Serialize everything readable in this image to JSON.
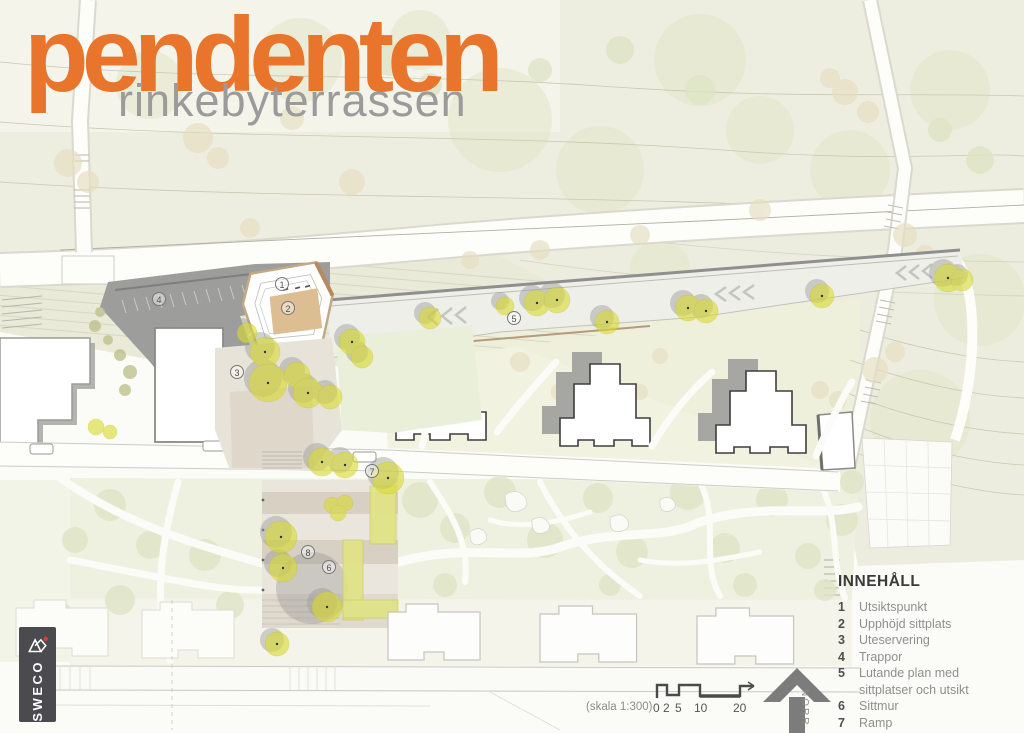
{
  "header": {
    "title": "pendenten",
    "subtitle": "rinkebyterrassen"
  },
  "colors": {
    "accent_orange": "#E8752B",
    "subtitle_gray": "#9B9B9B",
    "tree_yellow": "#D9DB33",
    "structure_gray": "#9D9D9B",
    "north_arrow_gray": "#7C7C7C"
  },
  "legend": {
    "heading": "INNEHÅLL",
    "items": [
      {
        "num": "1",
        "label": "Utsiktspunkt"
      },
      {
        "num": "2",
        "label": "Upphöjd sittplats"
      },
      {
        "num": "3",
        "label": "Uteservering"
      },
      {
        "num": "4",
        "label": "Trappor"
      },
      {
        "num": "5",
        "label": "Lutande plan med sittplatser och utsikt"
      },
      {
        "num": "6",
        "label": "Sittmur"
      },
      {
        "num": "7",
        "label": "Ramp"
      },
      {
        "num": "8",
        "label": "Bouleplan"
      }
    ]
  },
  "scale": {
    "label": "(skala 1:300)",
    "ticks": [
      "0",
      "2",
      "5",
      "10",
      "20"
    ]
  },
  "north": {
    "label": "NORR"
  },
  "logo": {
    "brand": "SWECO"
  },
  "plan": {
    "markers": [
      {
        "n": "1"
      },
      {
        "n": "2"
      },
      {
        "n": "3"
      },
      {
        "n": "4"
      },
      {
        "n": "5"
      },
      {
        "n": "6"
      },
      {
        "n": "7"
      },
      {
        "n": "8"
      }
    ]
  }
}
